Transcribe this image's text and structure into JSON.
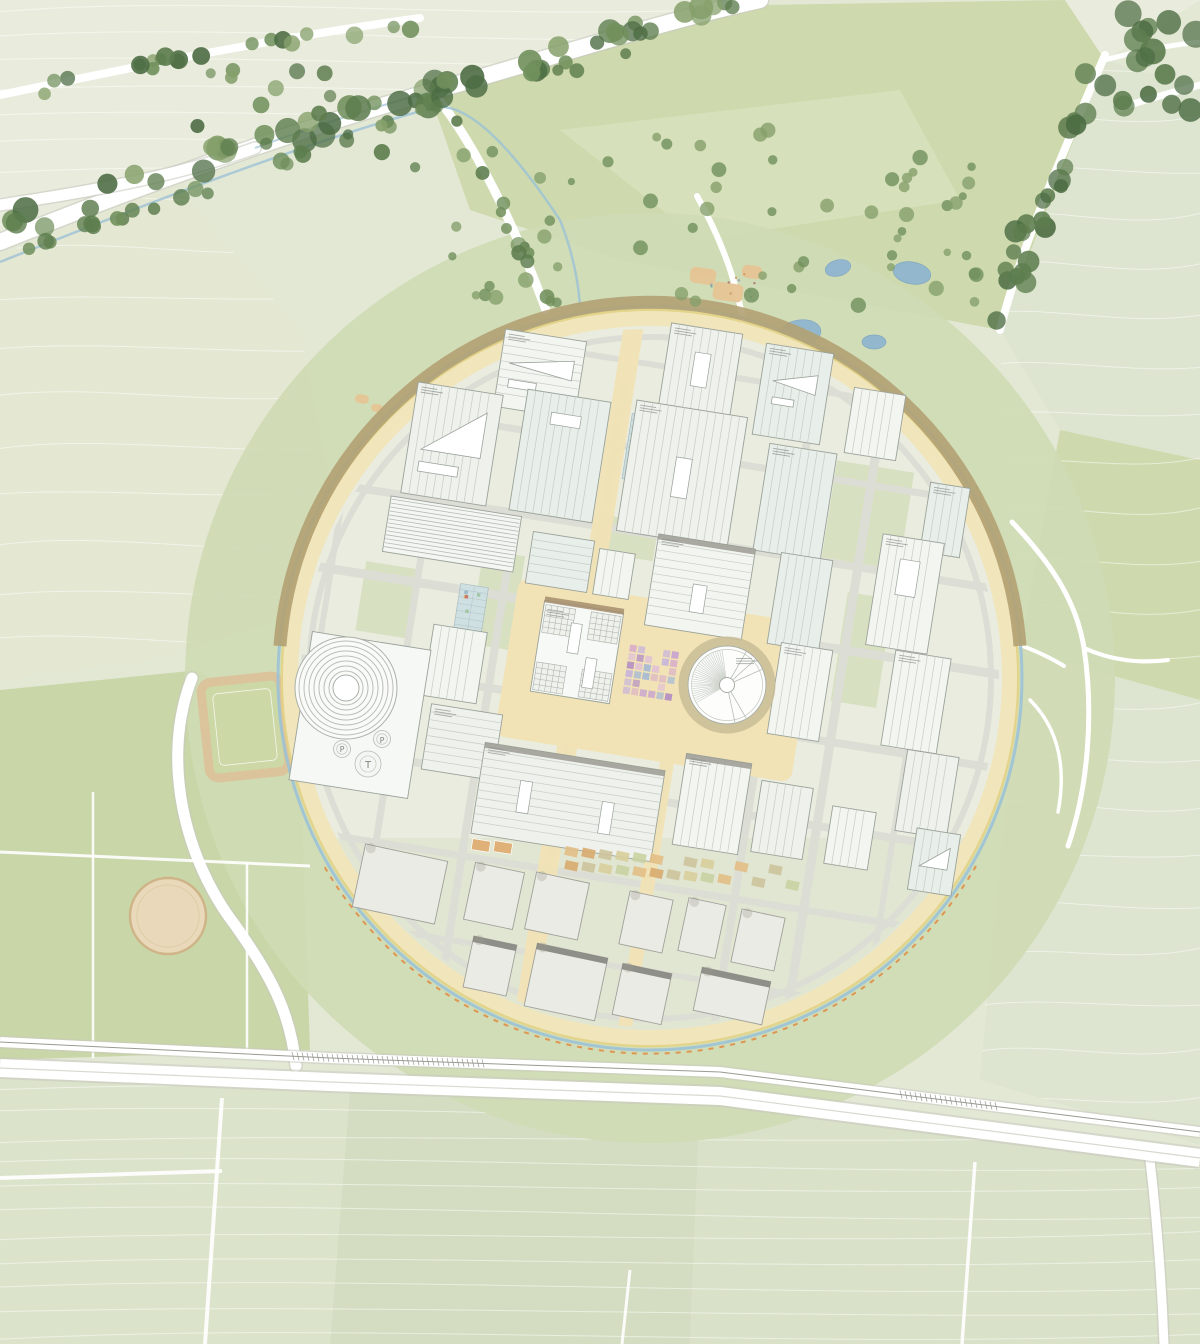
{
  "map": {
    "meta": {
      "type": "masterplan-site-plan"
    },
    "labels": {
      "parking_p": "P",
      "tower_t": "T"
    },
    "colors": {
      "base": "#e3e8d5",
      "field_pale": "#e9ecdd",
      "field_pale2": "#e4e7d2",
      "field_olive": "#dde4cf",
      "field_green": "#cbd8aa",
      "field_green2": "#c7d5a5",
      "park_ring": "#cfdbb4",
      "road_white": "#ffffff",
      "road_casing": "#c8c9c0",
      "stream": "#9cc2d6",
      "ring_cream": "#f1e5bc",
      "ring_brown": "#b2a173",
      "ring_yellow": "#e4d387",
      "dash_orange": "#e08a40",
      "campus_ground": "#e9ecde",
      "lawn": "#d5dfbc",
      "plaza_sand": "#f2e3b6",
      "street": "#dcddd4",
      "bldg_fill": "#eef1ec",
      "bldg_fill2": "#e8eee9",
      "bldg_fill3": "#f3f5f1",
      "bldg_stroke": "#9aa29a",
      "roof_line": "#c6cdc4",
      "skylight": "#ffffff",
      "box_fill": "#ebebe6",
      "box_stroke": "#a0a09a",
      "box_strip": "#85857e",
      "canopy_brown": "#a58d6c",
      "label_gray": "#8d938d",
      "trees": [
        "#4c6c43",
        "#5d7d4e",
        "#71905c",
        "#86a06b"
      ],
      "mosaic": [
        "#b18cc4",
        "#c7a2cf",
        "#d9afc9",
        "#9fb5d8",
        "#c4b1de",
        "#e2c2d4"
      ],
      "plots_blue": "#cfe0e2",
      "plots_grid": "#a9bcc0",
      "crops": [
        "#b8cc90",
        "#d6e3b4"
      ],
      "garden_plots": [
        "#e2be85",
        "#d8ab6e",
        "#cdc39c",
        "#d8ce9c",
        "#c9d2a2"
      ],
      "court_orange": "#dfb077",
      "playground_tan": "#e6c493",
      "sand_arena": "#e9d9ba",
      "track_tan": "#dbc49c",
      "pond": "#8db4d1",
      "pond_edge": "#7aa3c2",
      "haze": "#ffffff",
      "mark_dark": "#3c3c38"
    }
  }
}
